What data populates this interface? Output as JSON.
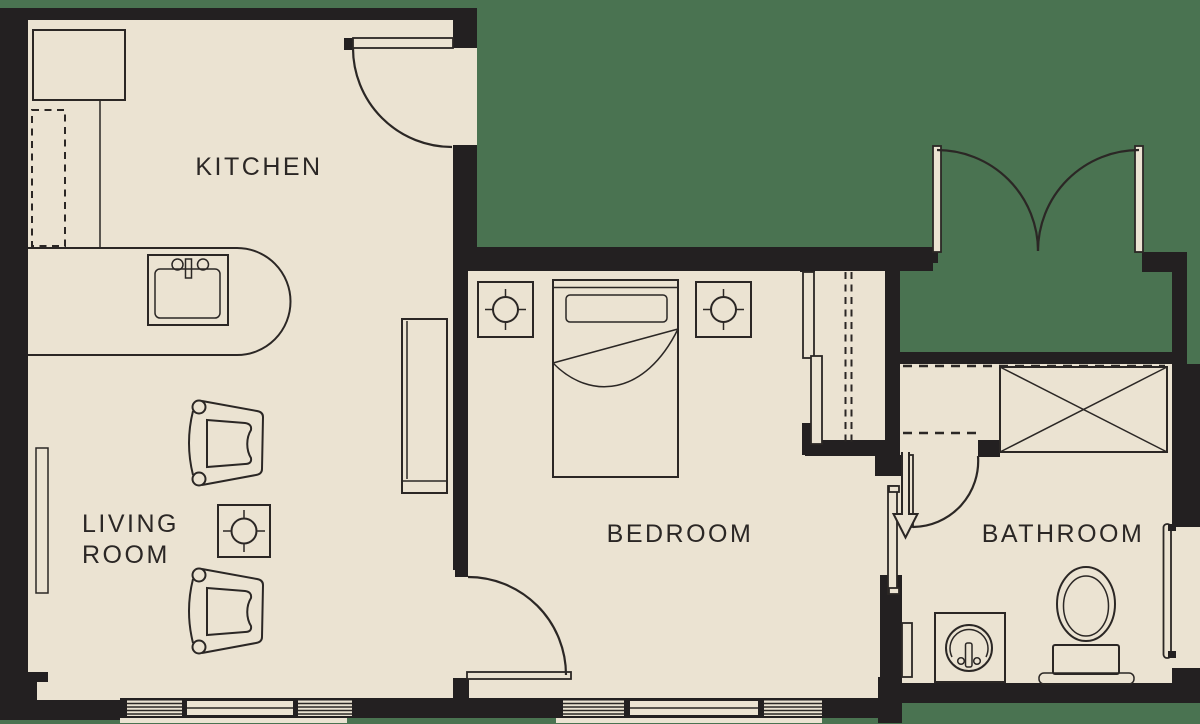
{
  "floor_plan": {
    "rooms": {
      "kitchen": {
        "label": "KITCHEN"
      },
      "living_room": {
        "label_line1": "LIVING",
        "label_line2": "ROOM"
      },
      "bedroom": {
        "label": "BEDROOM"
      },
      "bathroom": {
        "label": "BATHROOM"
      }
    },
    "colors": {
      "background": "#4a7351",
      "floor": "#ebe3d2",
      "wall": "#232021",
      "line": "#2b2725"
    },
    "fixtures": {
      "kitchen": [
        "refrigerator",
        "dishwasher",
        "counter-peninsula",
        "kitchen-sink"
      ],
      "living_room": [
        "armchair",
        "armchair",
        "side-table-lamp",
        "console-table",
        "wall-window"
      ],
      "bedroom": [
        "bed",
        "nightstand-lamp",
        "nightstand-lamp",
        "closet-sliding-doors",
        "closet-rod"
      ],
      "bathroom": [
        "shower",
        "toilet",
        "vanity-sink",
        "towel-bar-window",
        "entry-arrow"
      ],
      "doors": [
        "kitchen-entry-door",
        "french-double-doors",
        "bedroom-door",
        "bathroom-door"
      ]
    }
  }
}
